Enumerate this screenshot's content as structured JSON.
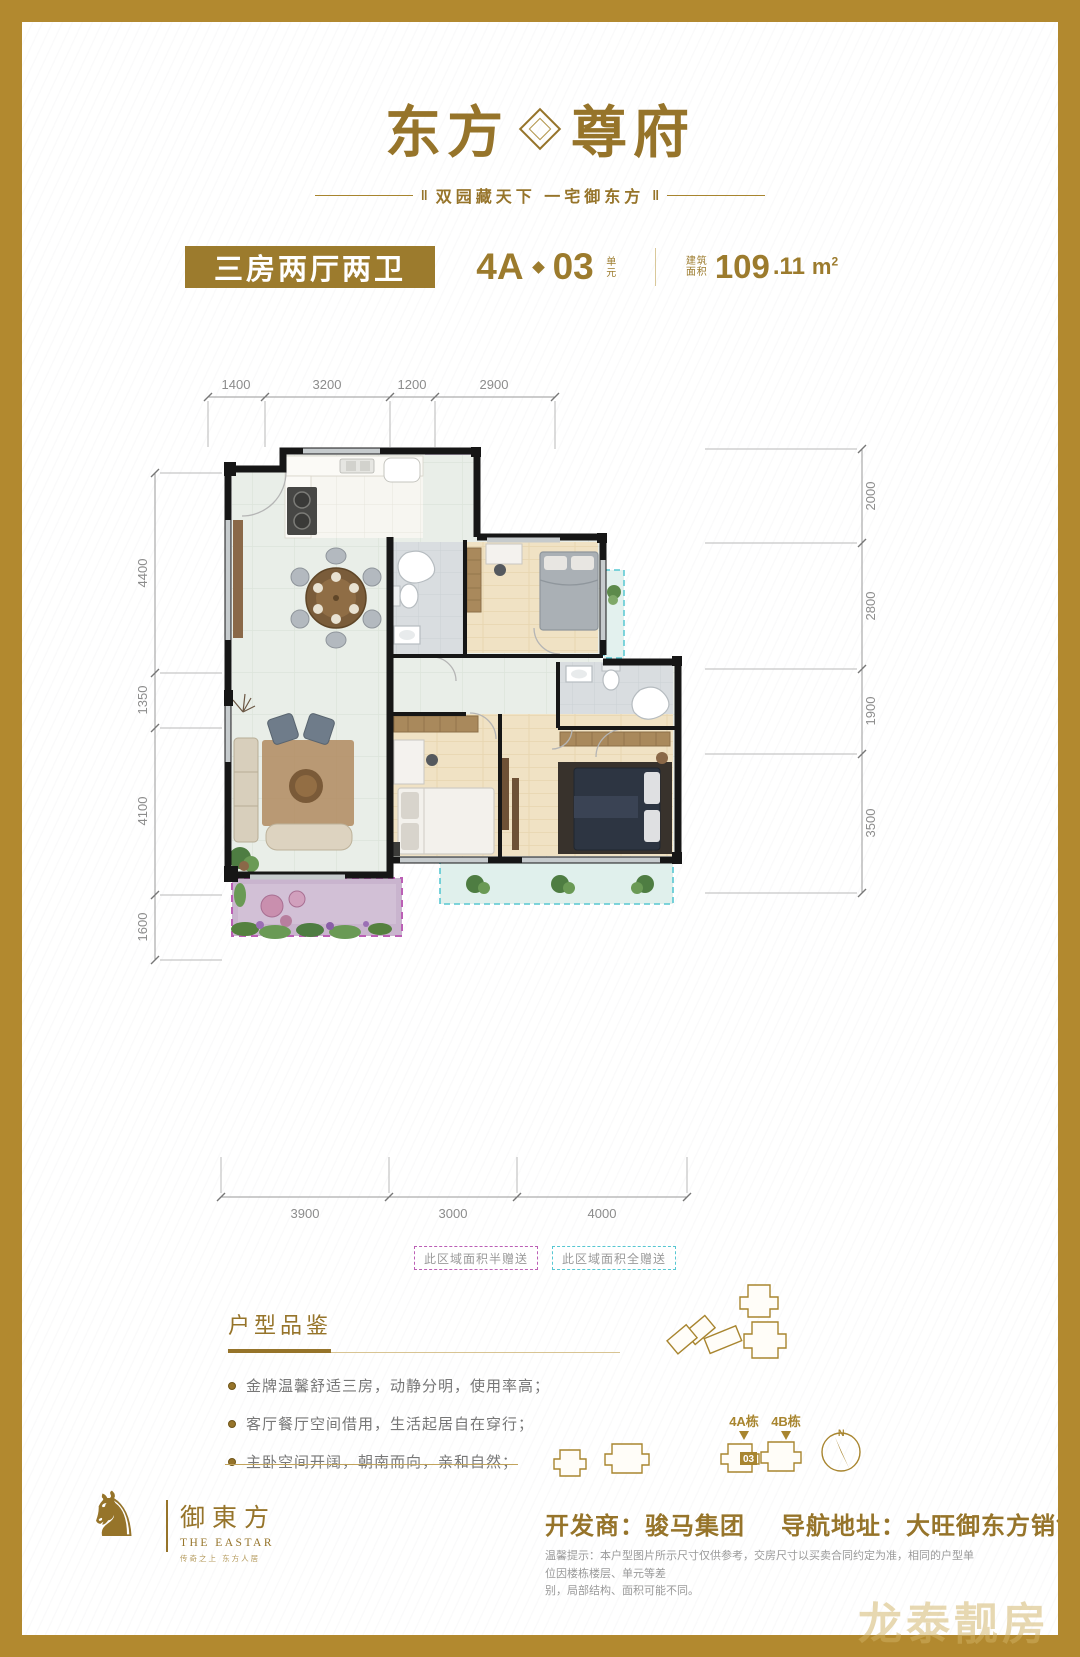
{
  "brand": {
    "logo_left": "东方",
    "logo_right": "尊府",
    "tagline": "双园藏天下  一宅御东方",
    "bar_mark": "‖"
  },
  "title_bar": {
    "layout_label": "三房两厅两卫",
    "unit_block": "4A",
    "unit_number": "03",
    "unit_suffix": "单元",
    "area_label_1": "建筑",
    "area_label_2": "面积",
    "area_int": "109",
    "area_dec": ".11",
    "area_unit": "m",
    "area_sup": "2"
  },
  "floor_plan": {
    "dimensions_top": [
      "1400",
      "3200",
      "1200",
      "2900"
    ],
    "dimensions_left": [
      "4400",
      "1350",
      "4100",
      "1600"
    ],
    "dimensions_right": [
      "2000",
      "2800",
      "1900",
      "3500"
    ],
    "dimensions_bottom": [
      "3900",
      "3000",
      "4000"
    ],
    "legend_half": "此区域面积半赠送",
    "legend_full": "此区域面积全赠送"
  },
  "features": {
    "heading": "户型品鉴",
    "items": [
      "金牌温馨舒适三房，动静分明，使用率高；",
      "客厅餐厅空间借用，生活起居自在穿行；",
      "主卧空间开阔，朝南而向，亲和自然；"
    ]
  },
  "site": {
    "tower_a": "4A栋",
    "tower_b": "4B栋",
    "unit_badge": "03",
    "compass_n": "N"
  },
  "footer": {
    "logo_cn": "御東方",
    "logo_en": "THE EASTAR",
    "logo_sub": "传奇之上  东方人居",
    "developer": "开发商：骏马集团",
    "address": "导航地址：大旺御东方销售中心",
    "disclaimer_1": "温馨提示：本户型图片所示尺寸仅供参考，交房尺寸以买卖合同约定为准，相同的户型单位因楼栋楼层、单元等差",
    "disclaimer_2": "别，局部结构、面积可能不同。"
  },
  "icons": {
    "horse": "♞"
  },
  "watermark": "龙泰靓房",
  "colors": {
    "gold": "#96742a",
    "frame": "#b2892f",
    "half_gift_purple": "#bb5fb5",
    "full_gift_teal": "#57c7d2"
  }
}
